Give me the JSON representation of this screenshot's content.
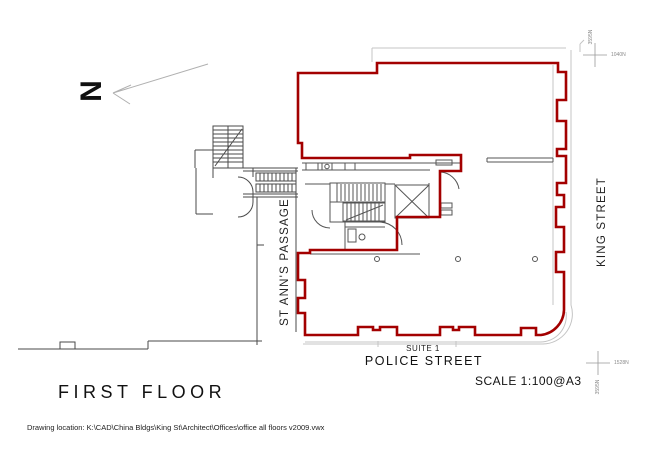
{
  "title_block": {
    "floor_label": "FIRST FLOOR",
    "scale_label": "SCALE 1:100@A3",
    "drawing_location": "Drawing location: K:\\CAD\\China Bldgs\\King St\\Architect\\Offices\\office all floors v2009.vwx"
  },
  "streets": {
    "king": "KING STREET",
    "police": "POLICE STREET",
    "passage": "ST ANN'S PASSAGE"
  },
  "labels": {
    "suite": "SUITE 1",
    "north": "N"
  },
  "survey_markers": {
    "top_horizontal": "1040N",
    "top_vertical": "3595N",
    "bottom_horizontal": "1528N",
    "bottom_vertical": "3595N"
  },
  "colors": {
    "outline_red": "#a30000",
    "wall_dark": "#444444",
    "wall_light": "#bfbfbf"
  }
}
